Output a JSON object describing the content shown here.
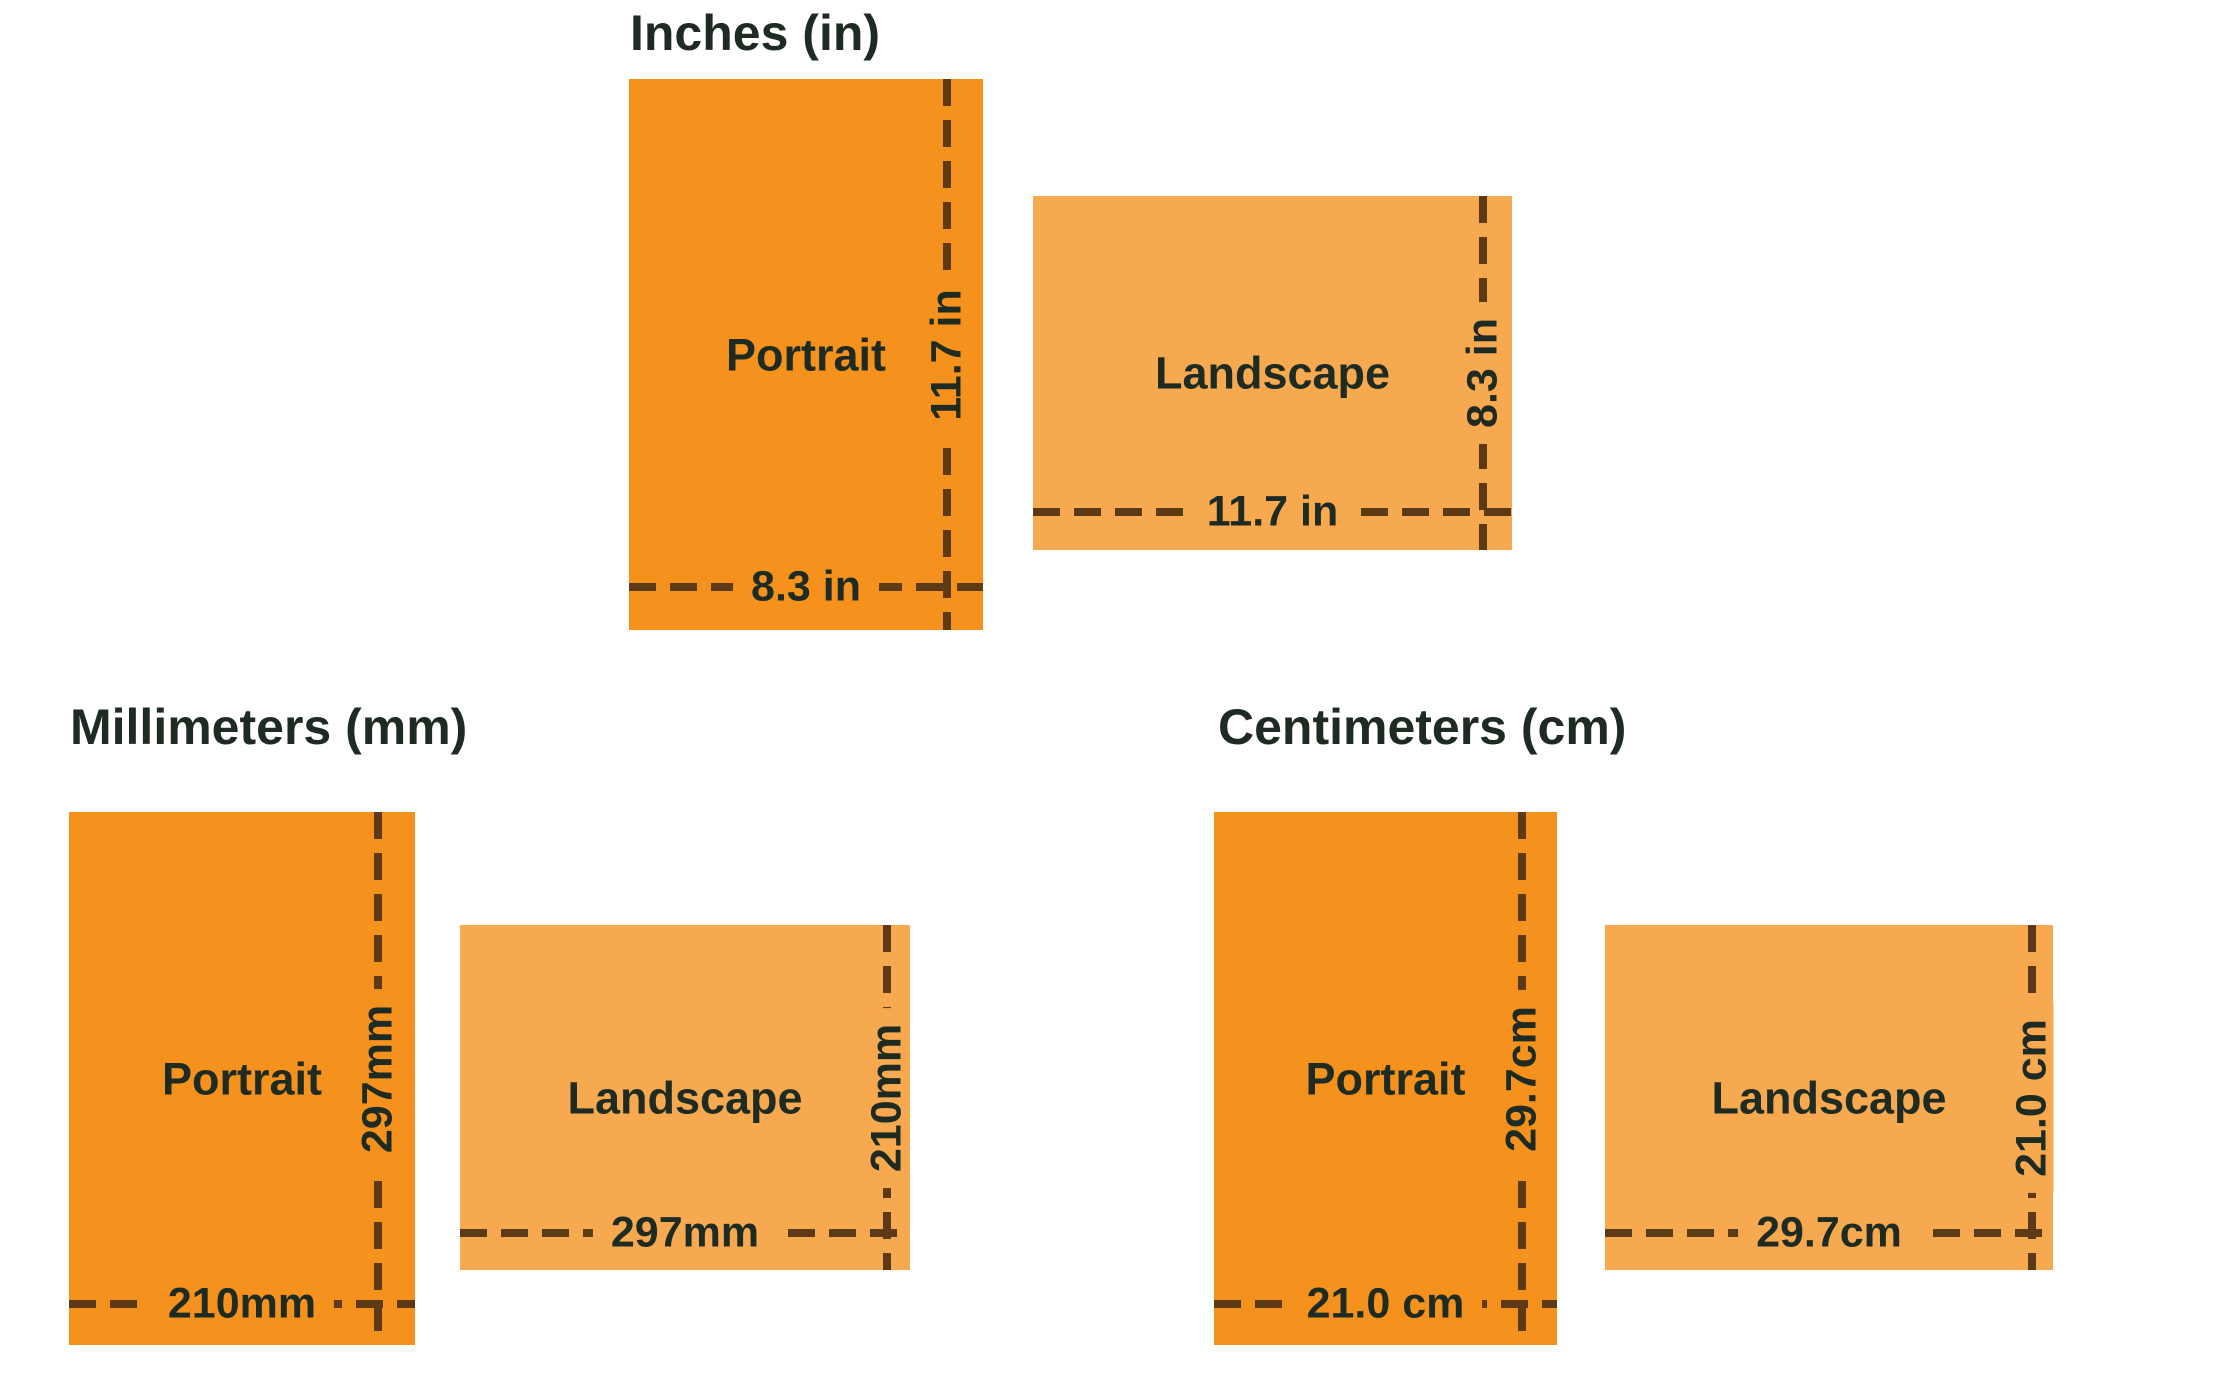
{
  "title": "A4 paper size in inches, millimeters and centimeters",
  "colors": {
    "portrait_fill": "#F5921E",
    "landscape_fill": "#F7A94F",
    "dash_line": "#5B3A15",
    "text": "#1E2B22",
    "background": "#FFFFFF"
  },
  "sections": {
    "inches": {
      "title": "Inches (in)",
      "portrait": {
        "label": "Portrait",
        "height_label": "11.7 in",
        "width_label": "8.3 in"
      },
      "landscape": {
        "label": "Landscape",
        "height_label": "8.3 in",
        "width_label": "11.7 in"
      }
    },
    "millimeters": {
      "title": "Millimeters (mm)",
      "portrait": {
        "label": "Portrait",
        "height_label": "297mm",
        "width_label": "210mm"
      },
      "landscape": {
        "label": "Landscape",
        "height_label": "210mm",
        "width_label": "297mm"
      }
    },
    "centimeters": {
      "title": "Centimeters (cm)",
      "portrait": {
        "label": "Portrait",
        "height_label": "29.7cm",
        "width_label": "21.0 cm"
      },
      "landscape": {
        "label": "Landscape",
        "height_label": "21.0 cm",
        "width_label": "29.7cm"
      }
    }
  }
}
